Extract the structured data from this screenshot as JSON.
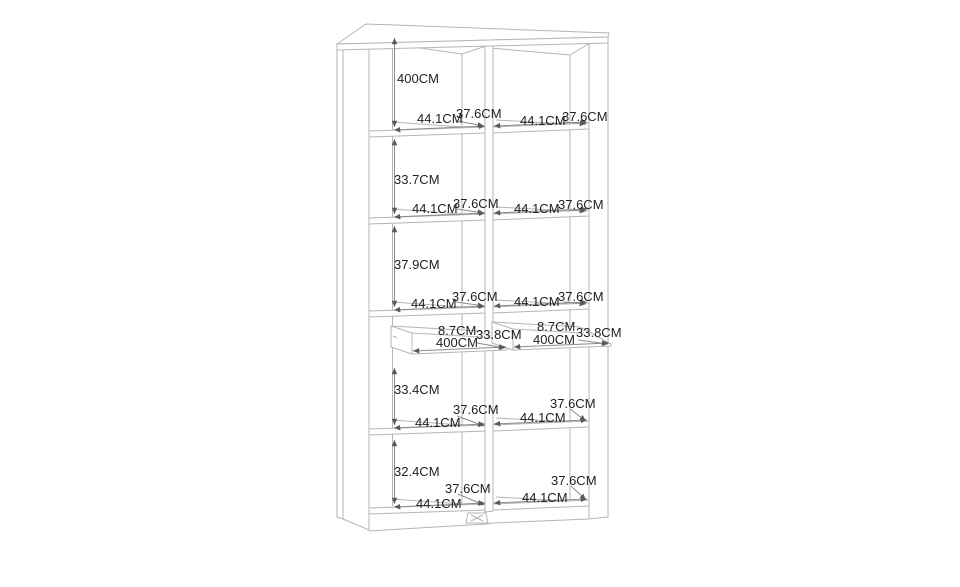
{
  "page": {
    "background": "#ffffff"
  },
  "colors": {
    "furniture_line": "#b5b5b5",
    "dimension_line": "#8c8c8c",
    "arrow": "#5a5a5a",
    "label_text": "#1f1f1f"
  },
  "diagram": {
    "kind": "cabinet-dimension-line-drawing",
    "unit": "CM",
    "labels": [
      {
        "id": "section-1-height",
        "text": "400CM",
        "x": 397,
        "y": 72
      },
      {
        "id": "shelf-1-left-width",
        "text": "44.1CM",
        "x": 417,
        "y": 112
      },
      {
        "id": "shelf-1-left-depth",
        "text": "37.6CM",
        "x": 456,
        "y": 107
      },
      {
        "id": "shelf-1-right-width",
        "text": "44.1CM",
        "x": 520,
        "y": 114
      },
      {
        "id": "shelf-1-right-depth",
        "text": "37.6CM",
        "x": 562,
        "y": 110
      },
      {
        "id": "section-2-height",
        "text": "33.7CM",
        "x": 394,
        "y": 173
      },
      {
        "id": "shelf-2-left-width",
        "text": "44.1CM",
        "x": 412,
        "y": 202
      },
      {
        "id": "shelf-2-left-depth",
        "text": "37.6CM",
        "x": 453,
        "y": 197
      },
      {
        "id": "shelf-2-right-width",
        "text": "44.1CM",
        "x": 514,
        "y": 202
      },
      {
        "id": "shelf-2-right-depth",
        "text": "37.6CM",
        "x": 558,
        "y": 198
      },
      {
        "id": "section-3-height",
        "text": "37.9CM",
        "x": 394,
        "y": 258
      },
      {
        "id": "shelf-3-left-width",
        "text": "44.1CM",
        "x": 411,
        "y": 297
      },
      {
        "id": "shelf-3-left-depth",
        "text": "37.6CM",
        "x": 452,
        "y": 290
      },
      {
        "id": "shelf-3-right-width",
        "text": "44.1CM",
        "x": 514,
        "y": 295
      },
      {
        "id": "shelf-3-right-depth",
        "text": "37.6CM",
        "x": 558,
        "y": 290
      },
      {
        "id": "drawer-left-height",
        "text": "8.7CM",
        "x": 438,
        "y": 324
      },
      {
        "id": "drawer-left-width",
        "text": "400CM",
        "x": 436,
        "y": 336
      },
      {
        "id": "drawer-left-depth",
        "text": "33.8CM",
        "x": 476,
        "y": 328
      },
      {
        "id": "drawer-right-height",
        "text": "8.7CM",
        "x": 537,
        "y": 320
      },
      {
        "id": "drawer-right-width",
        "text": "400CM",
        "x": 533,
        "y": 333
      },
      {
        "id": "drawer-right-depth",
        "text": "33.8CM",
        "x": 576,
        "y": 326
      },
      {
        "id": "section-4-height",
        "text": "33.4CM",
        "x": 394,
        "y": 383
      },
      {
        "id": "shelf-4-left-depth",
        "text": "37.6CM",
        "x": 453,
        "y": 403
      },
      {
        "id": "shelf-4-left-width",
        "text": "44.1CM",
        "x": 415,
        "y": 416
      },
      {
        "id": "shelf-4-right-depth",
        "text": "37.6CM",
        "x": 550,
        "y": 397
      },
      {
        "id": "shelf-4-right-width",
        "text": "44.1CM",
        "x": 520,
        "y": 411
      },
      {
        "id": "section-5-height",
        "text": "32.4CM",
        "x": 394,
        "y": 465
      },
      {
        "id": "shelf-5-left-depth",
        "text": "37.6CM",
        "x": 445,
        "y": 482
      },
      {
        "id": "shelf-5-left-width",
        "text": "44.1CM",
        "x": 416,
        "y": 497
      },
      {
        "id": "shelf-5-right-depth",
        "text": "37.6CM",
        "x": 551,
        "y": 474
      },
      {
        "id": "shelf-5-right-width",
        "text": "44.1CM",
        "x": 522,
        "y": 491
      }
    ]
  }
}
